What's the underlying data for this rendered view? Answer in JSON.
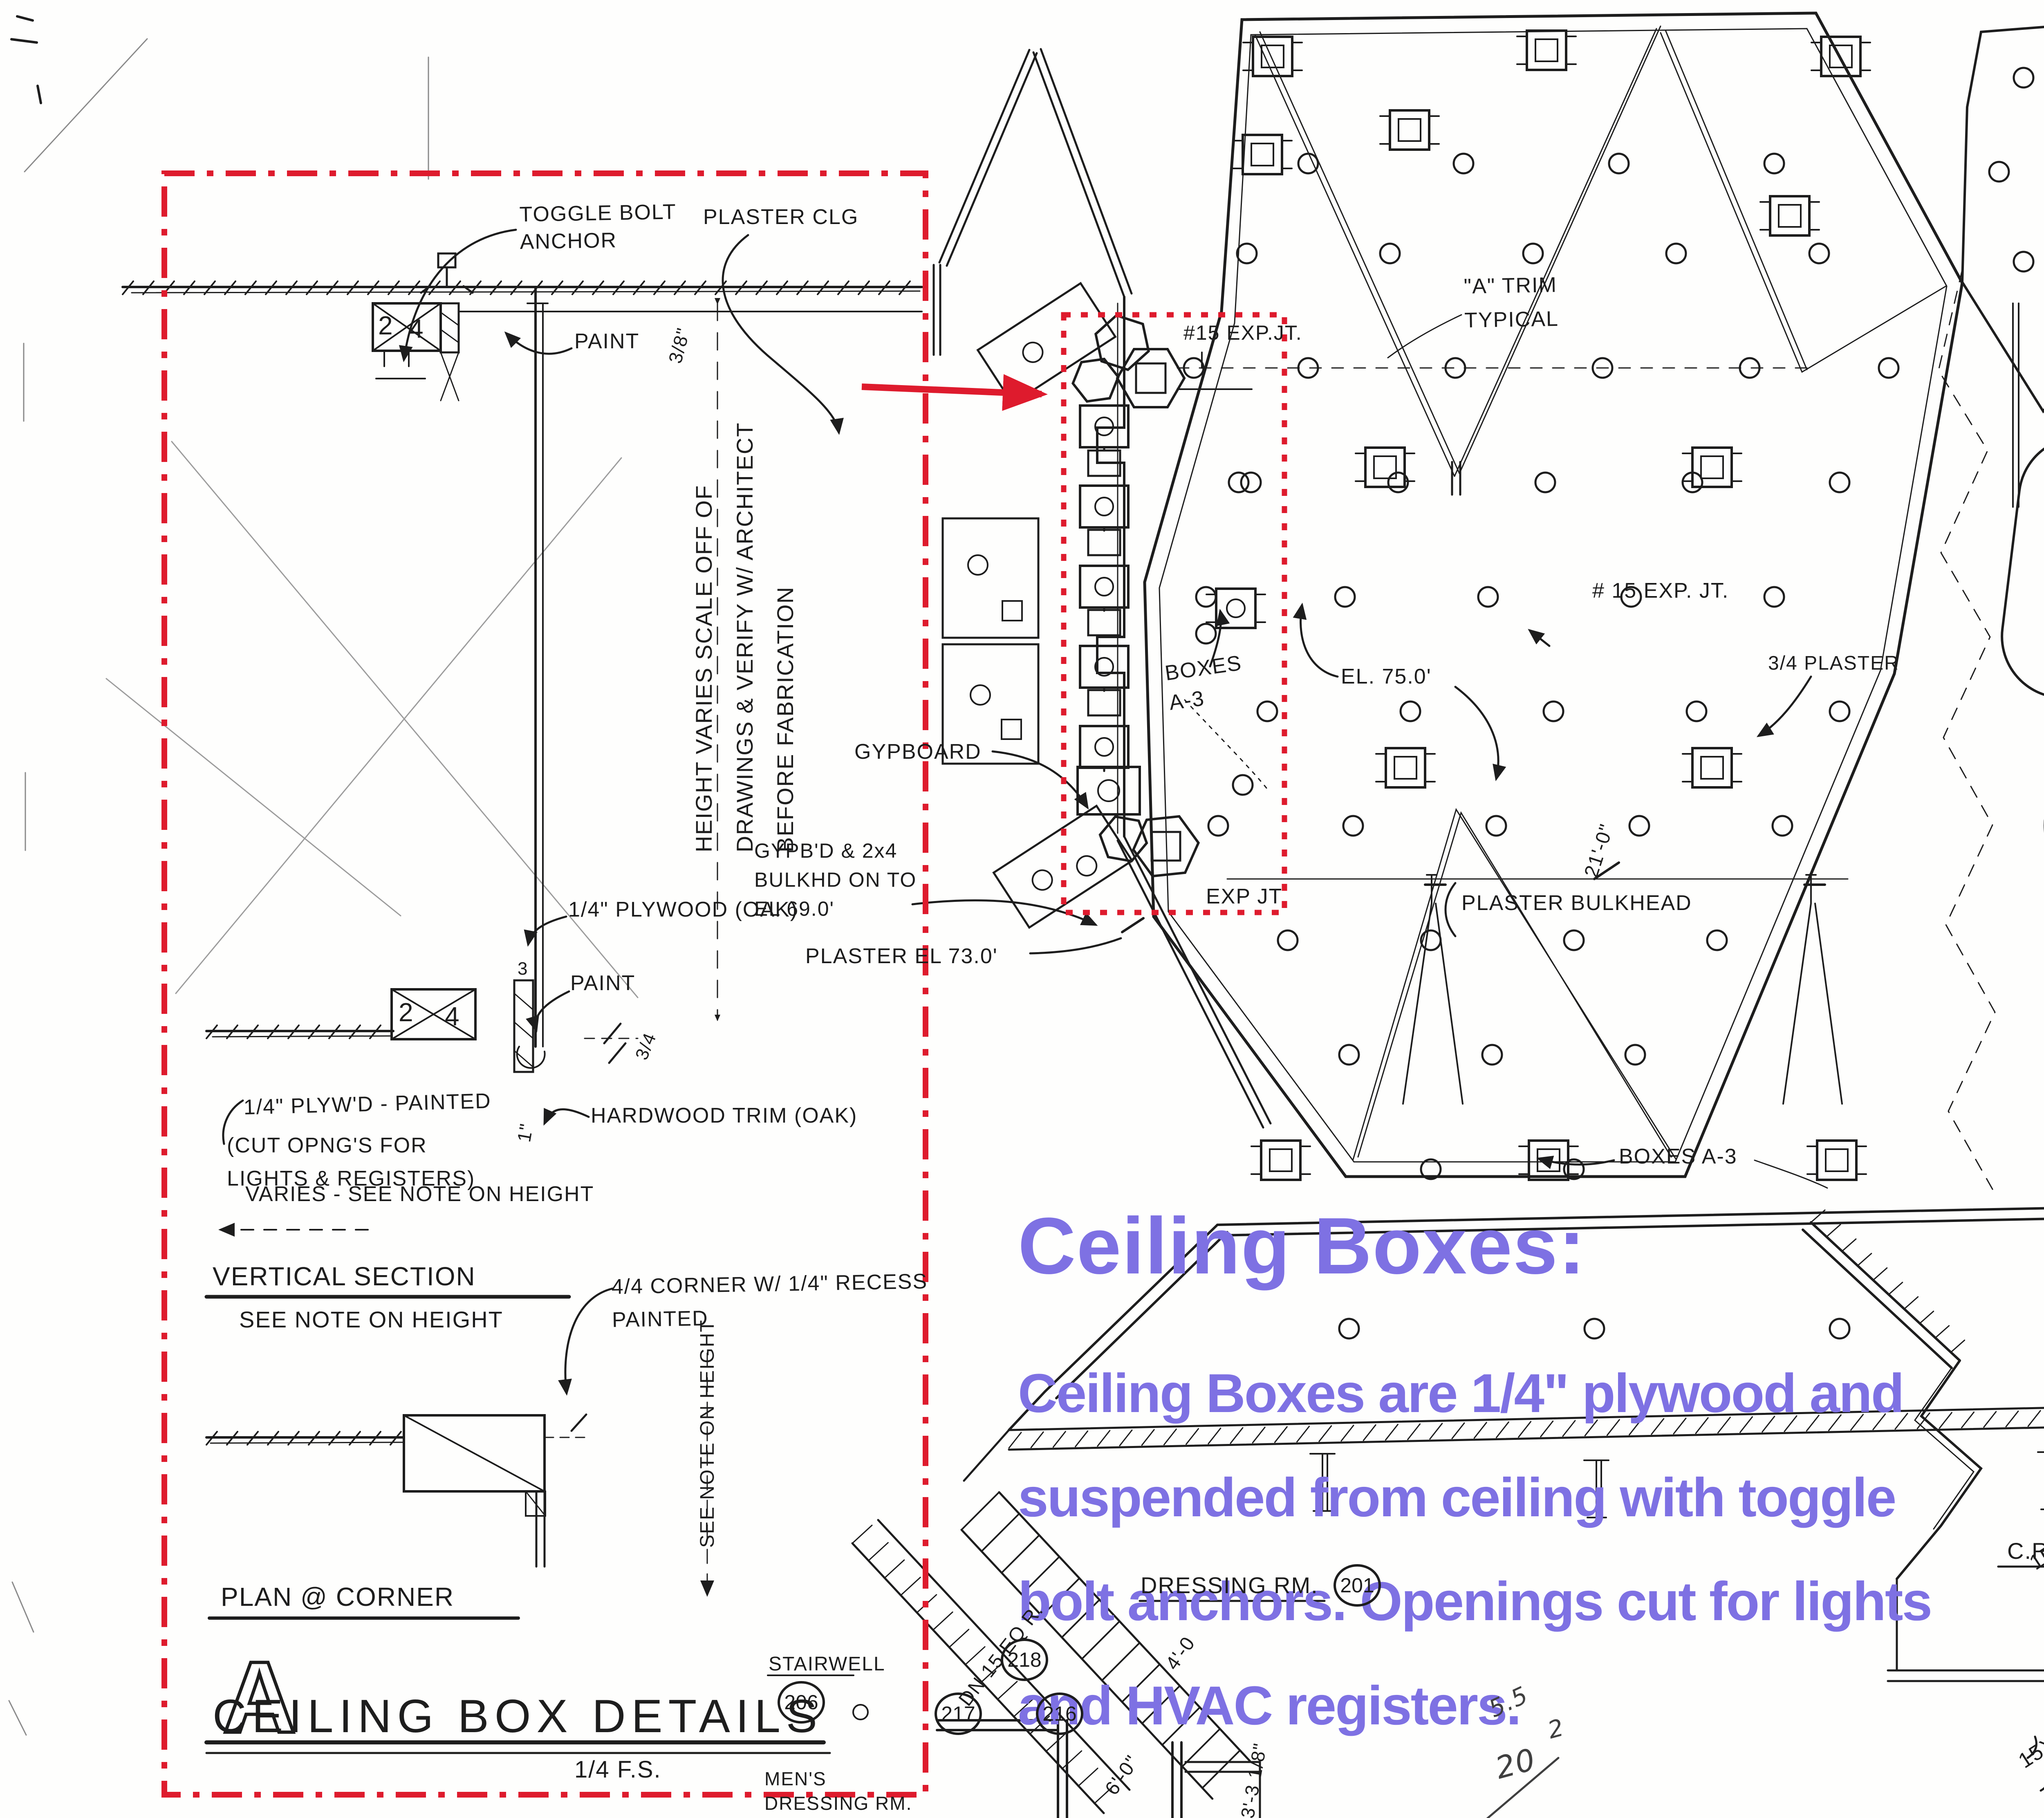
{
  "overlay": {
    "heading": "Ceiling Boxes:",
    "paragraph": "Ceiling Boxes are 1/4\" plywood and\nsuspended from ceiling with toggle\nbolt anchors.  Openings cut for lights\nand HVAC registers.",
    "accent_color": "#7e71e3",
    "highlight_color": "#de1b2d"
  },
  "labels": {
    "toggle_bolt_anchor": "TOGGLE BOLT\nANCHOR",
    "plaster_clg": "PLASTER CLG",
    "dim_3_8": "3/8\"",
    "paint_top": "PAINT",
    "height_note": "HEIGHT VARIES SCALE OFF OF\nDRAWINGS & VERIFY W/ ARCHITECT\nBEFORE FABRICATION",
    "plywood_oak": "1/4\" PLYWOOD (OAK)",
    "paint_mid": "PAINT",
    "dim_3_4": "3/4",
    "num_2_top": "2",
    "num_4_top": "4",
    "num_2_mid": "2",
    "num_4_mid": "4",
    "num_3_stud": "3",
    "plywd_painted": "1/4\" PLYW'D - PAINTED",
    "cut_opngs": "(CUT OPNG'S FOR\nLIGHTS & REGISTERS)",
    "hardwood_trim": "HARDWOOD TRIM (OAK)",
    "dim_1in": "1\"",
    "varies_note": "VARIES - SEE NOTE ON HEIGHT",
    "vertical_section": "VERTICAL SECTION",
    "see_note_height": "SEE NOTE ON HEIGHT",
    "corner_note": "4/4 CORNER W/ 1/4\" RECESS\nPAINTED",
    "see_note_height_v": "SEE NOTE ON HEIGHT",
    "plan_corner": "PLAN @ CORNER",
    "detail_letter": "A",
    "sheet_title": "CEILING BOX DETAILS",
    "scale_note": "1/4 F.S.",
    "stairwell": "STAIRWELL",
    "room_206": "206",
    "mens_dressing": "MEN'S\nDRESSING RM.",
    "gypboard": "GYPBOARD",
    "gypbd_note": "GYPB'D & 2x4\nBULKHD ON TO\nEL 69.0'",
    "plaster_el": "PLASTER EL 73.0'",
    "exp_jt_top": "#15 EXP.JT.",
    "a_trim": "\"A\" TRIM\nTYPICAL",
    "exp_jt_mid": "# 15 EXP. JT.",
    "boxes_a3": "BOXES\nA-3",
    "el_75": "EL. 75.0'",
    "plaster_34": "3/4 PLASTER",
    "dim_21": "21'-0\"",
    "plaster_bulkhead": "PLASTER BULKHEAD",
    "exp_jt_bot": "EXP JT",
    "boxes_a3_br": "BOXES A-3",
    "dim_4ft": "4'.",
    "dn_15": "DN 15 EQ R.",
    "room_218": "218",
    "room_217": "217",
    "room_216": "216",
    "dressing_rm": "DRESSING RM.",
    "room_201": "201",
    "dim_4_0": "4'-0",
    "dim_6_0": "6'-0\"",
    "dim_3_3": "3'-3 1/8\"",
    "scrawl_55": "5.5",
    "scrawl_2": "2",
    "scrawl_20": "20",
    "cr": "C.R.",
    "room_208": "208",
    "dim_15x27": "15x27",
    "dim_4_4": "4'-4\"",
    "dim_15x18": "15X18"
  }
}
